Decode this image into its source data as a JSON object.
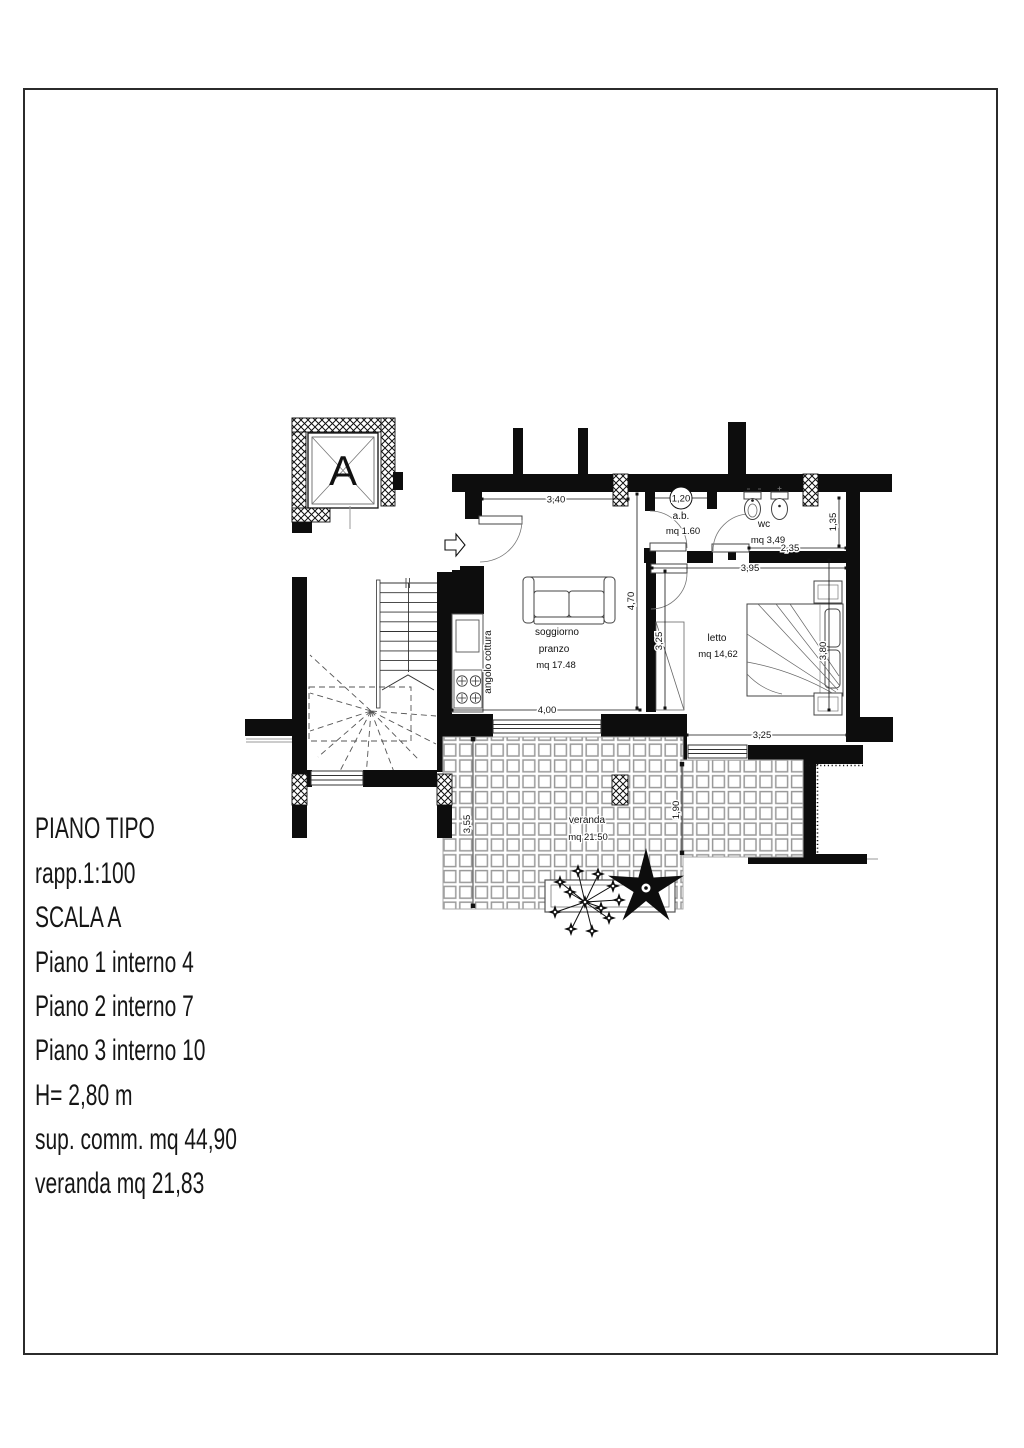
{
  "title_block": {
    "lines": [
      "PIANO TIPO",
      "rapp.1:100",
      "SCALA A",
      "Piano 1 interno 4",
      "Piano 2 interno 7",
      "Piano 3 interno 10",
      "H= 2,80 m",
      "sup. comm. mq 44,90",
      "veranda mq 21,83"
    ]
  },
  "plan": {
    "elevator_label": "A",
    "rooms": {
      "soggiorno": {
        "name1": "soggiorno",
        "name2": "pranzo",
        "area": "mq 17.48"
      },
      "kitchen": {
        "name": "angolo cottura"
      },
      "ab": {
        "name": "a.b.",
        "area": "mq 1.60"
      },
      "wc": {
        "name": "wc",
        "area": "mq 3,49"
      },
      "letto": {
        "name": "letto",
        "area": "mq 14,62"
      },
      "veranda": {
        "name": "veranda",
        "area": "mq 21.50"
      }
    },
    "dims": {
      "top_340": "3,40",
      "ab_120": "1,20",
      "wc_235": "2,35",
      "wc_135": "1,35",
      "letto_395": "3,95",
      "sogg_470": "4,70",
      "letto_w_325": "3,25",
      "letto_380": "3,80",
      "sogg_400": "4,00",
      "letto_s_325": "3,25",
      "ver_355": "3,55",
      "ver_190": "1,90"
    }
  },
  "colors": {
    "ink": "#111111",
    "tile_joint": "#9a9a9a",
    "accent": "#000000"
  }
}
